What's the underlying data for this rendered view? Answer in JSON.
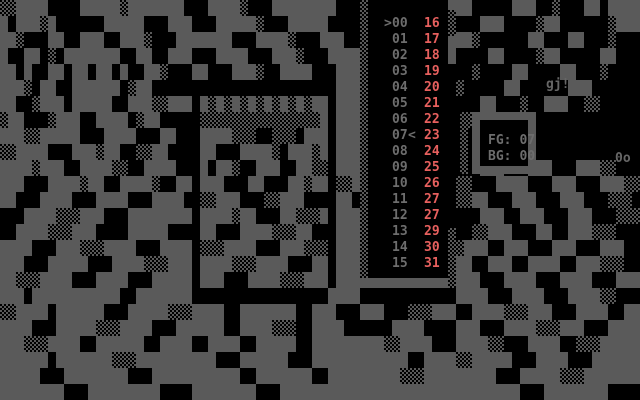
{
  "colors": {
    "art_gray": "#5a5a5a",
    "art_black": "#000000",
    "panel_background": "#000000",
    "number_gray": "#6d6d6d",
    "number_red": "#e7605e",
    "statusbox_frame_gray": "#5a5a5a"
  },
  "palette_panel": {
    "rows": [
      {
        "left": "00",
        "right": "16",
        "cursor": ">",
        "marker": ""
      },
      {
        "left": "01",
        "right": "17",
        "cursor": "",
        "marker": ""
      },
      {
        "left": "02",
        "right": "18",
        "cursor": "",
        "marker": ""
      },
      {
        "left": "03",
        "right": "19",
        "cursor": "",
        "marker": ""
      },
      {
        "left": "04",
        "right": "20",
        "cursor": "",
        "marker": ""
      },
      {
        "left": "05",
        "right": "21",
        "cursor": "",
        "marker": ""
      },
      {
        "left": "06",
        "right": "22",
        "cursor": "",
        "marker": ""
      },
      {
        "left": "07",
        "right": "23",
        "cursor": "",
        "marker": "<"
      },
      {
        "left": "08",
        "right": "24",
        "cursor": "",
        "marker": ""
      },
      {
        "left": "09",
        "right": "25",
        "cursor": "",
        "marker": ""
      },
      {
        "left": "10",
        "right": "26",
        "cursor": "",
        "marker": ""
      },
      {
        "left": "11",
        "right": "27",
        "cursor": "",
        "marker": ""
      },
      {
        "left": "12",
        "right": "27",
        "cursor": "",
        "marker": ""
      },
      {
        "left": "13",
        "right": "29",
        "cursor": "",
        "marker": ""
      },
      {
        "left": "14",
        "right": "30",
        "cursor": "",
        "marker": ""
      },
      {
        "left": "15",
        "right": "31",
        "cursor": "",
        "marker": ""
      }
    ]
  },
  "status_box": {
    "fg": {
      "label": "FG:",
      "value": "07"
    },
    "bg": {
      "label": "BG:",
      "value": "00"
    }
  },
  "signatures": {
    "artist_tag": "gj!",
    "corner_tag": "0o"
  },
  "artwork": {
    "cell_size": "8x16",
    "legend": {
      "X": "gray",
      ".": "black",
      "%": "dither"
    },
    "rows": [
      "%%XXXX....XXXXX%XXXXXXX...XXXX%...XXXXXXXX...............XX.....XXX..%...XX.XXXX",
      "X.XXX%X......XXXXX...XXX...XXXXX%...XXXXX...................XXX....%XX......%XXX",
      "XX%...XX..XXX..XXX%...XXXXXXX...XXXX%...XXX..............XX%......XX...XX...%...",
      "X..XX.%.XXXXXXX..XX..XXX...XXXX...XXX%...XXXX................XX....%XX.....XX...",
      "XX.X..XX.XX.XX.X..XX%...XX...XXX%..XXXX...XXX..............%....XX....XX...%....",
      "XXX%.XX..XXXXXX.%XX.......................XXX............%.....XX......XXX......",
      "XX..%XXX.XXXXX..XXX%%XXX.X%X%X%X%X%X%X%XX.XXX...............XX...%..XXX..%%.....",
      "%XX...%XXX..XXXX.%XX.....%%%%%%%%%%%%%%%X.XXX.............%.....................",
      "XXX%%XXXXX...XXXX...XX...XXXX%%%..%%%.XXX.XXX...................................",
      "%%XXXX...XXX%XX..%%XX....XX...XXXX%.XXX%X.XXX...................................",
      "XXXX%XXX..XXXX%%..XXXX...X.XX%..XXX..XX%%.XXX...............XXX...XXX...XXX%%...",
      "XXX...XXXX%XX..XXXX%..XX.XXX...XX...XX%XX.%%X............%%...XXXX...XXX...XXX%%",
      "XX...XXXX...XXXX...XXXX..%%XXX...%%XXX....XX.............%%XX...XXX...XXX...%%%.",
      "...XXXX%%%XXX...XXXXXXXX.XXXX%XX...XX%%%X.XXX...............XXX..XXX...XXX...%%%",
      "..XXXX%%%XXX....XXXXX....XX...XXXX%%%XX...XXX..............%%XXX...XX..XXX%%%...",
      "XXXX...XXX%%%XXXX...XXXX.%%%XXXX...XXX%%%.XXX............%XXX..XXX...XXX...XXX..",
      "XXX...XXXXX...XXXX%%%XXX.XXXX%%%XXXX...XX.XXX............XX..XXX..XXXX..XXX%%%..",
      "XX%%%XXXX...XXXX...XXXXX.XXX...XXXX%%%XXX.XXXXXXXXXXXXXX%XXX...XXXX...XXXX...XXX",
      "XXX.XXXXXXXXXXX..XXXXXXX.................XXXX............XXXX...XXXX...XXXX%%...",
      "%%XXXX.XXXXXX...XXXXX%%%XXXX..XXXXXXX..XXX...XXX...%%%XXX..XXXX%%%XXX...XXXX..XX",
      "XXXX...XXXXX%%%XXXX...XXXXXX..XXXX%%%..XXXX......XXXX....XXX...XXXX%%%XXX...XXXX",
      "XXX%%%XXXX..XXXXXX..XXXX..XXXX..XXXXX..XXXXXXXXX%%XXXX...XXXX%%...XXXX..%%%XXXXX",
      "XXXXXX.XXXXXXX%%%XXXXXXXXXX...XXXXXX...XXXXXXXXXXXX..XXXX%%XXXXX...XXXX...XXXXXX",
      "XXXXX...XXXXXXXX...XXXXXXXXXXX..XXXXXXX..XXXXXXXXX%%%XXXXXXXXX...XXXXX%%%XXXXXXX",
      "XXXXXXXX...XXXXXXXXX....XXXXXXXX...XXXXXXXXXXXXXXXXXXXXXXXXXXXXXX...XXXXXXXX....."
    ]
  }
}
